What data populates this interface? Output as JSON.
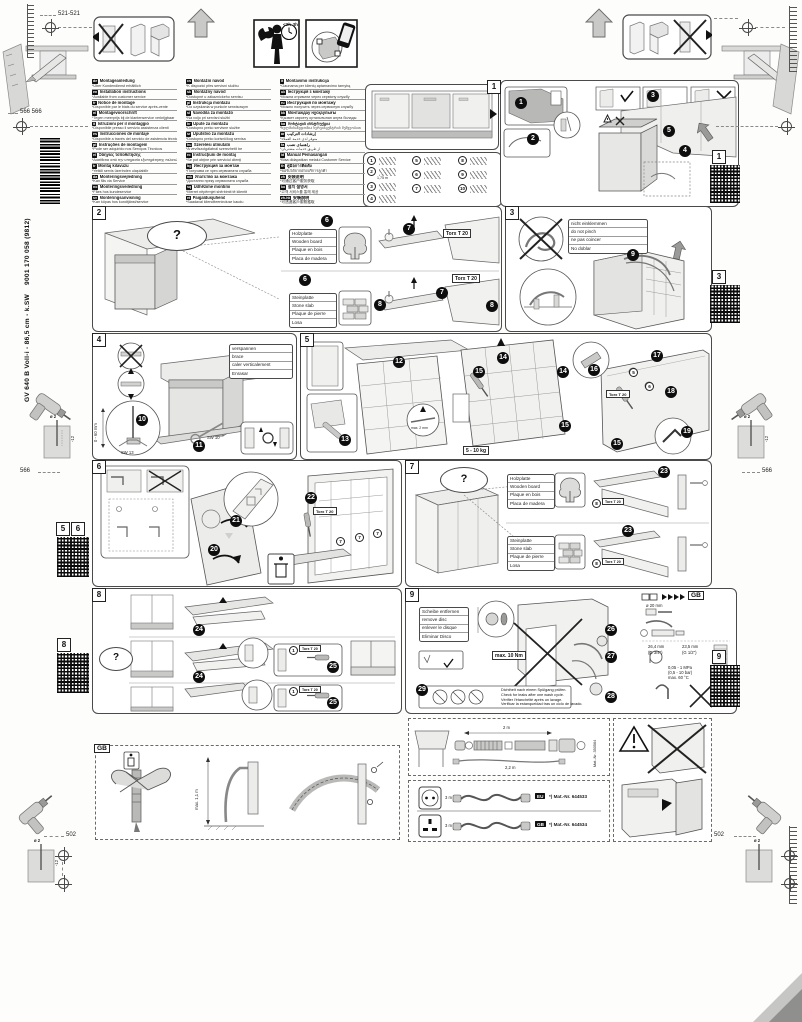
{
  "page": {
    "model": "GV 640 B Voll-i - 86,5 cm - k.SW",
    "doc_number": "9001 170 058 (9812)",
    "time_estimate": "<2h-3h"
  },
  "dims": {
    "top": "521-521",
    "upper_left": "566 566",
    "mid": "566",
    "bottom": "502",
    "drill_dia": "ø 2",
    "drill_depth": "-12"
  },
  "common": {
    "torx": "Torx T 20",
    "question": "?"
  },
  "languages": {
    "col1": [
      {
        "code": "de",
        "title": "Montageanleitung",
        "note": "*Über Kundendienst erhältlich"
      },
      {
        "code": "en",
        "title": "Installation instructions",
        "note": "*Available from customer service"
      },
      {
        "code": "fr",
        "title": "Notice de montage",
        "note": "*Disponible par le biais du service après-vente"
      },
      {
        "code": "nl",
        "title": "Montagevoorschrift",
        "note": "*Tegen meerprijs bij de klantenservice verkrijgbaar"
      },
      {
        "code": "it",
        "title": "Istruzioni per il montaggio",
        "note": "*Disponibile presso il servizio assistenza clienti"
      },
      {
        "code": "es",
        "title": "Instrucciones de montaje",
        "note": "*Disponible a través del servicio de asistencia técnica"
      },
      {
        "code": "pt",
        "title": "Instruções de montagem",
        "note": "*Pode ser adquirido nos Serviços Técnicos"
      },
      {
        "code": "el",
        "title": "Οδηγίες τοποθέτησης",
        "note": "*Διατίθεται από την υπηρεσία εξυπηρέτησης πελατών"
      },
      {
        "code": "tr",
        "title": "Montaj kılavuzu",
        "note": "*Yetkili servis üzerinden ulaşılabilir"
      },
      {
        "code": "da",
        "title": "Monteringsvejledning",
        "note": "*Kan fås via Service"
      },
      {
        "code": "no",
        "title": "Monteringsveiledning",
        "note": "*Fåes hos kundeservice"
      },
      {
        "code": "sv",
        "title": "Monteringsanvisning",
        "note": "*Kan köpas hos kundtjänst/service"
      },
      {
        "code": "fi",
        "title": "Asennusohje",
        "note": "*Saatavissa huoltopalvelusta"
      }
    ],
    "col2": [
      {
        "code": "cs",
        "title": "Montážní návod",
        "note": "*K dispozici přes servisní službu"
      },
      {
        "code": "sk",
        "title": "Montážny návod",
        "note": "*Dostupné u zákazníckeho servisu"
      },
      {
        "code": "pl",
        "title": "Instrukcja montażu",
        "note": "*Do uzyskania w punkcie serwisowym"
      },
      {
        "code": "sl",
        "title": "Navodila za montažo",
        "note": "*Na voljo pri servisni službi"
      },
      {
        "code": "hr",
        "title": "Upute za montažu",
        "note": "*Dostupno preko servisne službe"
      },
      {
        "code": "sr",
        "title": "Uputstvo za montažu",
        "note": "*Dostupno preko korisničkog servisa"
      },
      {
        "code": "hu",
        "title": "Szerelési útmutató",
        "note": "*A vevőszolgálatnál szerezhető be"
      },
      {
        "code": "ro",
        "title": "Instrucţiuni de montaj",
        "note": "*Se pot obţine prin serviciul clienţi"
      },
      {
        "code": "bg",
        "title": "Инструкция за монтаж",
        "note": "*Получава се чрез сервизната служба"
      },
      {
        "code": "mk",
        "title": "Упатство за монтажа",
        "note": "*Достапно преку сервисната служба"
      },
      {
        "code": "sq",
        "title": "Udhëzime montimi",
        "note": "*Merret nëpërmjet shërbimit të klientit"
      },
      {
        "code": "et",
        "title": "Paigaldusjuhend",
        "note": "*Saadaval klienditeeninduse kaudu"
      },
      {
        "code": "lv",
        "title": "Montāžas instrukcija",
        "note": "*Pieejama klientu servisā"
      }
    ],
    "col3": [
      {
        "code": "lt",
        "title": "Montavimo instrukcija",
        "note": "*Gaunama per klientų aptarnavimo tarnybą"
      },
      {
        "code": "uk",
        "title": "Інструкція з монтажу",
        "note": "*Можна отримати через сервісну службу"
      },
      {
        "code": "ru",
        "title": "Инструкция по монтажу",
        "note": "*Можно получить через сервисную службу"
      },
      {
        "code": "kk",
        "title": "Монтаждау нұсқаулығы",
        "note": "*Қызмет көрсету орталығынан алуға болады"
      },
      {
        "code": "ka",
        "title": "მონტაჟის ინსტრუქცია",
        "note": "*ხელმისაწვდომია სერვისცენტრის მეშვეობით"
      },
      {
        "code": "ar",
        "title": "إرشادات التركيب",
        "note": "*متوفر لدى خدمة العملاء"
      },
      {
        "code": "fa",
        "title": "راهنمای نصب",
        "note": "*از طریق خدمات مشتریان"
      },
      {
        "code": "id",
        "title": "Manual Pemasangan",
        "note": "*Bisa didapatkan melalui Customer Service"
      },
      {
        "code": "th",
        "title": "คู่มือการติดตั้ง",
        "note": "*ขอรับได้จากฝ่ายบริการลูกค้า"
      },
      {
        "code": "zh",
        "title": "安装说明",
        "note": "*可通过客户服务获取"
      },
      {
        "code": "ko",
        "title": "설치 설명서",
        "note": "*고객 서비스를 통해 제공"
      },
      {
        "code": "zh-hk",
        "title": "安裝說明",
        "note": "*可透過客戶服務獲取"
      },
      {
        "code": "he",
        "title": "הוראות התקנה",
        "note": "*זמין דרך שירות הלקוחות"
      }
    ]
  },
  "panels": {
    "p1": {
      "label": "1",
      "qr": "1",
      "steps": [
        "1",
        "2",
        "3",
        "4",
        "5"
      ],
      "parts": [
        "1",
        "2",
        "3",
        "4",
        "5",
        "6",
        "7",
        "8",
        "9",
        "10"
      ],
      "cord_length": "1,75 m"
    },
    "p2": {
      "label": "2",
      "steps": [
        "6",
        "7",
        "8"
      ],
      "wood": [
        "Holzplatte",
        "Wooden board",
        "Plaque en bois",
        "Placa de madera"
      ],
      "stone": [
        "Steinplatte",
        "Stone slab",
        "Plaque de pierre",
        "Losa"
      ]
    },
    "p3": {
      "label": "3",
      "qr": "3",
      "step": "9",
      "pinch": [
        "nicht einklemmen",
        "do not pinch",
        "ne pas coincer",
        "No doblar"
      ]
    },
    "p4": {
      "label": "4",
      "steps": [
        "10",
        "11"
      ],
      "brace": [
        "verspannen",
        "brace",
        "caler verticalement",
        "Enrasar"
      ],
      "sw13": "SW 13",
      "sw10": "SW 10",
      "range": "0 - 60 mm"
    },
    "p5": {
      "label": "5",
      "steps": [
        "12",
        "13",
        "14",
        "15",
        "16",
        "17",
        "18",
        "19"
      ],
      "weight": "5 - 10 kg",
      "gap": "max. 2 mm",
      "part_a": "5",
      "part_b": "6"
    },
    "p6": {
      "label": "6",
      "steps": [
        "20",
        "21",
        "22"
      ],
      "part_ref": "7"
    },
    "p7": {
      "label": "7",
      "step": "23",
      "screw_ref": "8"
    },
    "p8": {
      "label": "8",
      "qr": "8",
      "steps": [
        "24",
        "25"
      ],
      "screw_ref": "1"
    },
    "p9": {
      "label": "9",
      "qr": "9",
      "steps": [
        "26",
        "27",
        "28",
        "29"
      ],
      "disc": [
        "Scheibe entfernen",
        "remove disc",
        "enlever le disque",
        "Eliminar Disco"
      ],
      "torque": "max. 10 Nm",
      "leak": [
        "Dichtheit nach einem Spülgang prüfen.",
        "Check for leaks after one wash cycle.",
        "Vérifier l'étanchéité après un lavage.",
        "Verificar la estanqueidad tras un ciclo de lavado."
      ],
      "gb_ref": "GB",
      "hole_dia": "ø 20 mm",
      "nut_large": "26,4 mm",
      "nut_small": "23,5 mm",
      "thread_large": "(G 3/4\")",
      "thread_small": "(G 1/2\")",
      "pressure_mpa": "0,05 - 1 MPa",
      "pressure_bar": "(0,5 - 10 bar)",
      "temp_max": "max. 60 °C"
    },
    "qr56": [
      "5",
      "6"
    ]
  },
  "bottom": {
    "gb_label": "GB",
    "drain_max": "max. 1,1 m",
    "extension": {
      "len": "2 m",
      "len2": "2,2 m",
      "mat": "Mat.-Nr. 350564"
    },
    "cords": [
      {
        "plug": "EU",
        "len": "3 m",
        "mat": "*) Mat.-Nr. 644533"
      },
      {
        "plug": "GB",
        "len": "3 m",
        "mat": "*) Mat.-Nr. 644534"
      }
    ]
  }
}
